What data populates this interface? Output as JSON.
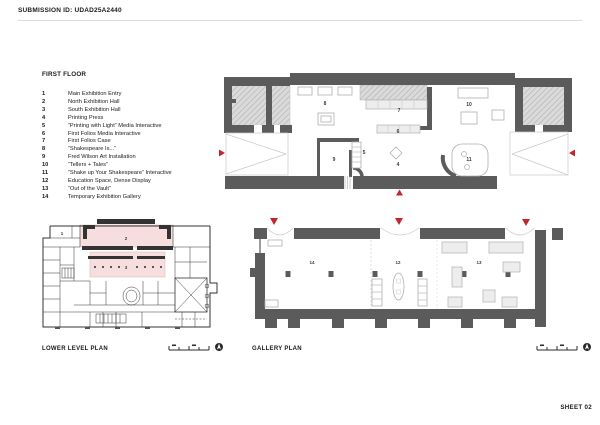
{
  "header": {
    "submission_label": "SUBMISSION ID: UDAD25A2440"
  },
  "sheet": {
    "number_label": "SHEET 02"
  },
  "legend": {
    "title": "FIRST FLOOR",
    "items": [
      {
        "num": "1",
        "label": "Main Exhibition Entry"
      },
      {
        "num": "2",
        "label": "North Exhibition Hall"
      },
      {
        "num": "3",
        "label": "South Exhibition Hall"
      },
      {
        "num": "4",
        "label": "Printing Press"
      },
      {
        "num": "5",
        "label": "“Printing with Light” Media Interactive"
      },
      {
        "num": "6",
        "label": "First Folios Media Interactive"
      },
      {
        "num": "7",
        "label": "First Folios Case"
      },
      {
        "num": "8",
        "label": "“Shakespeare Is...”"
      },
      {
        "num": "9",
        "label": "Fred Wilson Art Installation"
      },
      {
        "num": "10",
        "label": "“Tellers + Tales”"
      },
      {
        "num": "11",
        "label": "“Shake up Your Shakespeare” Interactive"
      },
      {
        "num": "12",
        "label": "Education Space, Dense Display"
      },
      {
        "num": "13",
        "label": "“Out of the Vault”"
      },
      {
        "num": "14",
        "label": "Temporary Exhibition Gallery"
      }
    ]
  },
  "plans": {
    "first_floor": {
      "room_labels": [
        "8",
        "7",
        "10",
        "6",
        "9",
        "5",
        "4",
        "11"
      ]
    },
    "lower_level": {
      "title": "LOWER LEVEL PLAN",
      "room_labels": [
        "1",
        "2",
        "3"
      ]
    },
    "gallery": {
      "title": "GALLERY PLAN",
      "room_labels": [
        "14",
        "12",
        "13"
      ]
    }
  },
  "colors": {
    "wall_gray": "#5b5b5b",
    "hatch_gray": "#dadada",
    "highlight_pink": "#f6dede",
    "marker_red": "#c1272d",
    "furniture_gray": "#b0b0b0"
  }
}
